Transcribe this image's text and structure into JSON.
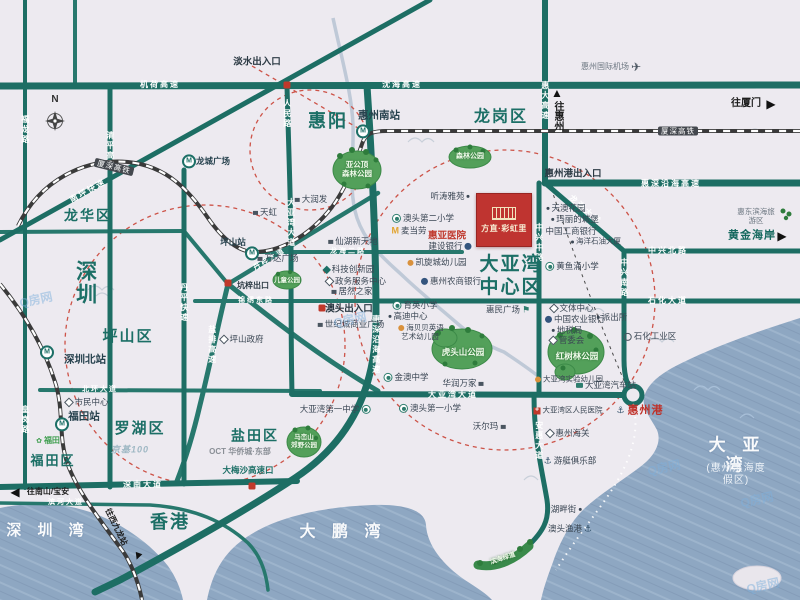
{
  "project": {
    "name": "方直·彩虹里"
  },
  "compass": {
    "label": "N"
  },
  "watermark": {
    "text": "Q房网"
  },
  "colors": {
    "road_teal": "#1d6e64",
    "district_teal": "#1c6f66",
    "project_red": "#bf3430",
    "water_blue": "#8ea7c2",
    "park_green": "#53a05a",
    "alert_red": "#cd5348"
  },
  "labels": [
    {
      "t": "龙岗区",
      "x": 501,
      "y": 117,
      "c": "d",
      "s": 16,
      "n": "district-longgang"
    },
    {
      "t": "惠阳",
      "x": 328,
      "y": 122,
      "c": "d",
      "s": 18,
      "n": "district-huiyang"
    },
    {
      "t": "龙华区",
      "x": 88,
      "y": 216,
      "c": "d",
      "s": 14,
      "n": "district-longhua"
    },
    {
      "t": "深圳",
      "x": 85,
      "y": 283,
      "c": "d",
      "s": 21,
      "v": 1,
      "n": "district-shenzhen"
    },
    {
      "t": "坪山区",
      "x": 128,
      "y": 337,
      "c": "d",
      "s": 15,
      "n": "district-pingshan"
    },
    {
      "t": "罗湖区",
      "x": 140,
      "y": 429,
      "c": "d",
      "s": 15,
      "n": "district-luohu"
    },
    {
      "t": "福田区",
      "x": 53,
      "y": 461,
      "c": "d",
      "s": 13,
      "n": "district-futian"
    },
    {
      "t": "盐田区",
      "x": 255,
      "y": 436,
      "c": "d",
      "s": 14,
      "n": "district-yantian"
    },
    {
      "t": "香港",
      "x": 170,
      "y": 523,
      "c": "d",
      "s": 18,
      "n": "district-hongkong"
    },
    {
      "t": "大亚湾\n中心区",
      "x": 511,
      "y": 277,
      "c": "d",
      "s": 19,
      "n": "district-dayawan-center"
    },
    {
      "t": "深 圳 湾",
      "x": 48,
      "y": 531,
      "c": "w",
      "s": 15,
      "n": "water-shenzhen-bay"
    },
    {
      "t": "大 鹏 湾",
      "x": 343,
      "y": 532,
      "c": "w",
      "s": 16,
      "n": "water-dapeng-bay"
    },
    {
      "t": "大 亚 湾",
      "x": 737,
      "y": 456,
      "c": "w",
      "s": 17,
      "n": "water-daya-bay"
    },
    {
      "t": "(惠州滨海度假区)",
      "x": 736,
      "y": 475,
      "c": "ws",
      "s": 10,
      "n": "water-daya-bay-subtitle"
    },
    {
      "t": "机荷高速",
      "x": 160,
      "y": 85,
      "c": "rh",
      "n": "road-jihe-expwy"
    },
    {
      "t": "沈海高速",
      "x": 402,
      "y": 85,
      "c": "rh",
      "n": "road-shenhai-expwy"
    },
    {
      "t": "惠大高速",
      "x": 545,
      "y": 101,
      "c": "rv",
      "n": "road-huida-expwy"
    },
    {
      "t": "惠深沿海高速",
      "x": 671,
      "y": 184,
      "c": "rh",
      "n": "road-huishen-coastal-e"
    },
    {
      "t": "龙海大道",
      "x": 585,
      "y": 210,
      "c": "rh",
      "r": 41,
      "n": "road-longhai-ave"
    },
    {
      "t": "中兴北路",
      "x": 668,
      "y": 251,
      "c": "rh",
      "n": "road-zhongxing-north"
    },
    {
      "t": "中兴南路",
      "x": 624,
      "y": 278,
      "c": "rv",
      "n": "road-zhongxing-south"
    },
    {
      "t": "中兴中路",
      "x": 539,
      "y": 243,
      "c": "rv",
      "n": "road-zhongxing-middle"
    },
    {
      "t": "石化大道",
      "x": 668,
      "y": 301,
      "c": "rh",
      "n": "road-shihua-ave"
    },
    {
      "t": "大亚湾大道",
      "x": 453,
      "y": 395,
      "c": "rh",
      "n": "road-dayawan-ave-h"
    },
    {
      "t": "安惠大道",
      "x": 539,
      "y": 441,
      "c": "rv",
      "n": "road-anhui-ave"
    },
    {
      "t": "惠深沿海高速",
      "x": 376,
      "y": 345,
      "c": "rv",
      "n": "road-huishen-coastal-v"
    },
    {
      "t": "深南大道",
      "x": 143,
      "y": 485,
      "c": "rh",
      "n": "road-shennan-ave"
    },
    {
      "t": "滨河大道",
      "x": 66,
      "y": 503,
      "c": "rh",
      "s": 7,
      "n": "road-binhe-ave"
    },
    {
      "t": "北环大道",
      "x": 100,
      "y": 390,
      "c": "rh",
      "s": 7,
      "n": "road-beihuan-ave"
    },
    {
      "t": "清平高速",
      "x": 110,
      "y": 151,
      "c": "rv",
      "n": "road-qingping-expwy"
    },
    {
      "t": "福龙路",
      "x": 25,
      "y": 130,
      "c": "rv",
      "n": "road-fulong"
    },
    {
      "t": "皇岗路",
      "x": 25,
      "y": 420,
      "c": "rv",
      "n": "road-huanggang"
    },
    {
      "t": "丹平快速",
      "x": 184,
      "y": 303,
      "c": "rv",
      "n": "road-danping-expwy"
    },
    {
      "t": "盐排高速",
      "x": 212,
      "y": 345,
      "c": "rv",
      "n": "road-yanpai-expwy"
    },
    {
      "t": "南坪快速",
      "x": 88,
      "y": 191,
      "c": "rh",
      "r": -29,
      "n": "road-nanping-expwy"
    },
    {
      "t": "人民路",
      "x": 287,
      "y": 114,
      "c": "rv",
      "n": "road-renmin"
    },
    {
      "t": "大亚湾大道",
      "x": 291,
      "y": 223,
      "c": "rv",
      "n": "road-dayawan-ave-v"
    },
    {
      "t": "龙海二路",
      "x": 348,
      "y": 252,
      "c": "rh",
      "s": 7,
      "n": "road-longhai-2"
    },
    {
      "t": "锦绣东路",
      "x": 256,
      "y": 301,
      "c": "rh",
      "s": 7,
      "n": "road-jinxiu-east"
    },
    {
      "t": "丹梓大道",
      "x": 270,
      "y": 260,
      "c": "rh",
      "r": -31,
      "s": 7,
      "n": "road-danzi-ave"
    },
    {
      "t": "厦深高铁",
      "x": 114,
      "y": 167,
      "c": "rl",
      "r": 14,
      "n": "rail-xiashen-hsr-w"
    },
    {
      "t": "厦深高铁",
      "x": 678,
      "y": 131,
      "c": "rl",
      "n": "rail-xiashen-hsr-e"
    },
    {
      "t": "惠州南站",
      "x": 379,
      "y": 116,
      "c": "st",
      "n": "station-huizhou-south"
    },
    {
      "t": "坪山站",
      "x": 233,
      "y": 242,
      "c": "st2",
      "n": "station-pingshan"
    },
    {
      "t": "深圳北站",
      "x": 85,
      "y": 360,
      "c": "st",
      "n": "station-shenzhen-north"
    },
    {
      "t": "福田站",
      "x": 84,
      "y": 417,
      "c": "st",
      "n": "station-futian"
    },
    {
      "t": "龙城广场",
      "x": 213,
      "y": 161,
      "c": "st2",
      "n": "station-longcheng-square"
    },
    {
      "c": "icm",
      "x": 363,
      "y": 131,
      "n": "metro-icon-huizhou-south"
    },
    {
      "c": "icm",
      "x": 252,
      "y": 253,
      "n": "metro-icon-pingshan"
    },
    {
      "c": "icm",
      "x": 47,
      "y": 352,
      "n": "metro-icon-shenzhen-north"
    },
    {
      "c": "icm",
      "x": 62,
      "y": 424,
      "n": "metro-icon-futian"
    },
    {
      "c": "icm",
      "x": 189,
      "y": 161,
      "n": "metro-icon-longcheng"
    },
    {
      "t": "淡水出入口",
      "x": 257,
      "y": 62,
      "c": "gate",
      "n": "gate-danshui"
    },
    {
      "t": "惠州港出入口",
      "x": 573,
      "y": 174,
      "c": "gate",
      "n": "gate-huizhou-port"
    },
    {
      "t": "澳头出入口",
      "x": 349,
      "y": 309,
      "c": "gate",
      "n": "gate-aotou"
    },
    {
      "t": "坑梓出口",
      "x": 253,
      "y": 286,
      "c": "gate",
      "s": 8,
      "n": "gate-kengzi"
    },
    {
      "t": "大梅沙高速口",
      "x": 248,
      "y": 470,
      "c": "gate2",
      "n": "gate-dameisha"
    },
    {
      "t": "▲",
      "x": 557,
      "y": 93,
      "c": "dirA",
      "n": "arrow-up-to-huizhou"
    },
    {
      "t": "往惠州",
      "x": 557,
      "y": 116,
      "c": "dir",
      "v": 1,
      "n": "dir-to-huizhou"
    },
    {
      "t": "往厦门",
      "x": 746,
      "y": 104,
      "c": "dir",
      "n": "dir-to-xiamen"
    },
    {
      "t": "▶",
      "x": 771,
      "y": 104,
      "c": "dirA",
      "n": "arrow-right-to-xiamen"
    },
    {
      "t": "黄金海岸",
      "x": 752,
      "y": 236,
      "c": "coast",
      "n": "poi-golden-coast"
    },
    {
      "t": "▶",
      "x": 782,
      "y": 236,
      "c": "dirA",
      "n": "arrow-right-golden-coast"
    },
    {
      "t": "◀",
      "x": 15,
      "y": 492,
      "c": "dirA",
      "n": "arrow-left-nanshan"
    },
    {
      "t": "往南山/宝安",
      "x": 48,
      "y": 492,
      "c": "dir",
      "s": 8,
      "n": "dir-to-nanshan-baoan"
    },
    {
      "t": "往西九龙站",
      "x": 116,
      "y": 527,
      "c": "dir",
      "r": 64,
      "s": 8,
      "n": "dir-to-west-kowloon"
    },
    {
      "t": "▼",
      "x": 138,
      "y": 556,
      "c": "dirA",
      "r": 20,
      "n": "arrow-down-west-kowloon"
    },
    {
      "t": "天虹",
      "x": 264,
      "y": 212,
      "c": "poi",
      "ic": "mall",
      "n": "poi-tianhong"
    },
    {
      "t": "大润发",
      "x": 310,
      "y": 199,
      "c": "poi",
      "ic": "mall",
      "n": "poi-rtmart"
    },
    {
      "t": "万达广场",
      "x": 277,
      "y": 258,
      "c": "poi",
      "ic": "mall",
      "n": "poi-wanda-plaza"
    },
    {
      "t": "坪山政府",
      "x": 241,
      "y": 339,
      "c": "poi",
      "ic": "gov",
      "n": "poi-pingshan-gov"
    },
    {
      "t": "市民中心",
      "x": 86,
      "y": 402,
      "c": "poi",
      "ic": "gov",
      "n": "poi-civic-center"
    },
    {
      "t": "京基100",
      "x": 130,
      "y": 450,
      "c": "lg1",
      "n": "poi-kk100"
    },
    {
      "t": "福田",
      "x": 47,
      "y": 441,
      "c": "lg2",
      "ic": "flower",
      "n": "poi-futian-logo"
    },
    {
      "t": "OCT 华侨城·东部",
      "x": 240,
      "y": 452,
      "c": "lg3",
      "n": "poi-oct-east"
    },
    {
      "t": "听涛雅苑",
      "x": 451,
      "y": 196,
      "c": "poi",
      "ic": "dot",
      "icr": 1,
      "n": "poi-tingtao-yayuan"
    },
    {
      "t": "澳头第二小学",
      "x": 422,
      "y": 218,
      "c": "poi",
      "ic": "school",
      "n": "poi-aotou-2nd-primary"
    },
    {
      "t": "麦当劳",
      "x": 408,
      "y": 231,
      "c": "poi",
      "ic": "mcd",
      "n": "poi-mcdonalds"
    },
    {
      "t": "惠亚医院",
      "x": 447,
      "y": 236,
      "c": "red1",
      "n": "poi-huiya-hospital"
    },
    {
      "t": "建设银行",
      "x": 451,
      "y": 246,
      "c": "poi",
      "ic": "bank",
      "icr": 1,
      "n": "poi-ccb-bank"
    },
    {
      "t": "凯旋城幼儿园",
      "x": 436,
      "y": 262,
      "c": "poi",
      "ic": "kid",
      "n": "poi-kaixuancheng-kindergarten"
    },
    {
      "t": "惠州农商银行",
      "x": 450,
      "y": 281,
      "c": "poi",
      "ic": "bank",
      "n": "poi-huizhou-rural-bank"
    },
    {
      "t": "仙湖新天地",
      "x": 352,
      "y": 241,
      "c": "poi",
      "ic": "mall",
      "n": "poi-xianhu-xintiandi"
    },
    {
      "t": "科技创新园",
      "x": 348,
      "y": 269,
      "c": "poi",
      "ic": "dia",
      "n": "poi-tech-innovation-park"
    },
    {
      "t": "政务服务中心",
      "x": 355,
      "y": 281,
      "c": "poi",
      "ic": "gov",
      "n": "poi-gov-service-center"
    },
    {
      "t": "居然之家",
      "x": 351,
      "y": 291,
      "c": "poi",
      "ic": "mall",
      "n": "poi-juran-home"
    },
    {
      "t": "世纪城商业广场",
      "x": 350,
      "y": 324,
      "c": "poi",
      "ic": "mall",
      "n": "poi-century-city-plaza"
    },
    {
      "t": "育英小学",
      "x": 414,
      "y": 305,
      "c": "poi",
      "ic": "school",
      "n": "poi-yuying-primary"
    },
    {
      "t": "高迪中心",
      "x": 407,
      "y": 316,
      "c": "poi",
      "ic": "dot",
      "n": "poi-gaodi-center"
    },
    {
      "t": "海贝贝英语\n艺术幼儿园",
      "x": 420,
      "y": 332,
      "c": "poi",
      "ic": "kid",
      "s": 7.5,
      "n": "poi-haibeibei-kindergarten"
    },
    {
      "t": "金澳中学",
      "x": 405,
      "y": 377,
      "c": "poi",
      "ic": "school",
      "n": "poi-jinao-middle-school"
    },
    {
      "t": "华润万家",
      "x": 464,
      "y": 383,
      "c": "poi",
      "ic": "mall",
      "icr": 1,
      "n": "poi-cr-vanguard"
    },
    {
      "t": "大亚湾第一中学",
      "x": 336,
      "y": 409,
      "c": "poi",
      "ic": "school",
      "icr": 1,
      "n": "poi-dayawan-1st-middle"
    },
    {
      "t": "澳头第一小学",
      "x": 429,
      "y": 408,
      "c": "poi",
      "ic": "school",
      "n": "poi-aotou-1st-primary"
    },
    {
      "t": "沃尔玛",
      "x": 490,
      "y": 426,
      "c": "poi",
      "ic": "mall",
      "icr": 1,
      "n": "poi-walmart"
    },
    {
      "t": "惠民广场",
      "x": 509,
      "y": 310,
      "c": "poi",
      "ic": "flag",
      "icr": 1,
      "n": "poi-huimin-square"
    },
    {
      "t": "文体中心",
      "x": 571,
      "y": 308,
      "c": "poi",
      "ic": "gov",
      "n": "poi-sports-center"
    },
    {
      "t": "中国农业银行",
      "x": 574,
      "y": 319,
      "c": "poi",
      "ic": "bank",
      "n": "poi-abc-bank"
    },
    {
      "t": "地税局",
      "x": 566,
      "y": 330,
      "c": "poi",
      "ic": "dot",
      "n": "poi-tax-bureau"
    },
    {
      "t": "管委会",
      "x": 566,
      "y": 340,
      "c": "poi",
      "ic": "gov",
      "n": "poi-admin-committee"
    },
    {
      "t": "派出所",
      "x": 611,
      "y": 317,
      "c": "poi",
      "ic": "dot",
      "n": "poi-police-station"
    },
    {
      "t": "天澳花园",
      "x": 565,
      "y": 208,
      "c": "poi",
      "ic": "dot",
      "n": "poi-tianao-garden"
    },
    {
      "t": "玛丽的城堡",
      "x": 574,
      "y": 219,
      "c": "poi",
      "ic": "dot",
      "n": "poi-marys-castle"
    },
    {
      "t": "中国工商银行",
      "x": 571,
      "y": 231,
      "c": "poi",
      "n": "poi-icbc-bank"
    },
    {
      "t": "海洋石油大厦",
      "x": 595,
      "y": 241,
      "c": "poi",
      "ic": "dot",
      "s": 7.5,
      "n": "poi-cnooc-tower"
    },
    {
      "t": "黄鱼涌小学",
      "x": 571,
      "y": 266,
      "c": "poi",
      "ic": "school",
      "n": "poi-huangyuchong-primary"
    },
    {
      "t": "石化工业区",
      "x": 649,
      "y": 336,
      "c": "poi",
      "ic": "ring",
      "n": "poi-petrochemical-zone"
    },
    {
      "t": "大亚湾实验幼儿园",
      "x": 568,
      "y": 379,
      "c": "poi",
      "ic": "kid",
      "s": 7.5,
      "n": "poi-dayawan-exp-kindergarten"
    },
    {
      "t": "大亚湾汽车站",
      "x": 605,
      "y": 385,
      "c": "poi",
      "ic": "bus",
      "n": "poi-dayawan-bus-station"
    },
    {
      "t": "大亚湾区人民医院",
      "x": 567,
      "y": 410,
      "c": "poi",
      "ic": "hosp",
      "s": 7.5,
      "n": "poi-dayawan-peoples-hospital"
    },
    {
      "t": "惠州海关",
      "x": 567,
      "y": 433,
      "c": "poi",
      "ic": "gov",
      "n": "poi-huizhou-customs"
    },
    {
      "t": "游艇俱乐部",
      "x": 569,
      "y": 461,
      "c": "poi",
      "ic": "anchor",
      "n": "poi-yacht-club"
    },
    {
      "t": "湖畔街",
      "x": 567,
      "y": 509,
      "c": "poi",
      "ic": "dot",
      "icr": 1,
      "n": "poi-hupan-street"
    },
    {
      "t": "澳头渔港",
      "x": 571,
      "y": 529,
      "c": "poi",
      "ic": "anchor",
      "icr": 1,
      "n": "poi-aotou-fishing-port"
    },
    {
      "t": "惠东滨海旅游区",
      "x": 756,
      "y": 216,
      "c": "poi2",
      "s": 7.5,
      "n": "poi-huidong-coastal-resort"
    },
    {
      "t": "惠州国际机场",
      "x": 612,
      "y": 67,
      "c": "poi2",
      "ic": "plane",
      "icr": 1,
      "n": "poi-huizhou-airport"
    },
    {
      "t": "惠州港",
      "x": 639,
      "y": 411,
      "c": "port",
      "ic": "anchor",
      "n": "poi-huizhou-port"
    },
    {
      "t": "亚公顶\n森林公园",
      "x": 357,
      "y": 169,
      "c": "park",
      "s": 7.5,
      "n": "park-yagongding"
    },
    {
      "t": "森林公园",
      "x": 470,
      "y": 157,
      "c": "park",
      "s": 7,
      "n": "park-forest"
    },
    {
      "t": "儿童公园",
      "x": 287,
      "y": 281,
      "c": "park",
      "s": 6.5,
      "n": "park-children"
    },
    {
      "t": "虎头山公园",
      "x": 463,
      "y": 352,
      "c": "park",
      "s": 8.5,
      "n": "park-hutoushan"
    },
    {
      "t": "红树林公园",
      "x": 577,
      "y": 356,
      "c": "park",
      "s": 8.5,
      "n": "park-mangrove"
    },
    {
      "t": "马峦山\n郊野公园",
      "x": 304,
      "y": 442,
      "c": "park",
      "s": 6.5,
      "n": "park-maluanshan"
    },
    {
      "t": "滨海绿道",
      "x": 503,
      "y": 559,
      "c": "park",
      "s": 6.5,
      "r": -18,
      "n": "park-coastal-greenway"
    },
    {
      "t": "N",
      "x": 55,
      "y": 100,
      "c": "cn",
      "n": "compass-north-label"
    },
    {
      "t": "Q房网",
      "x": 36,
      "y": 300,
      "c": "wm",
      "r": -12,
      "n": "watermark-1"
    },
    {
      "t": "Q房网",
      "x": 350,
      "y": 320,
      "c": "wm",
      "r": -12,
      "n": "watermark-2"
    },
    {
      "t": "Q房网",
      "x": 664,
      "y": 468,
      "c": "wm",
      "r": -12,
      "n": "watermark-3"
    },
    {
      "t": "Q房网",
      "x": 757,
      "y": 500,
      "c": "wm",
      "r": -12,
      "n": "watermark-4"
    },
    {
      "t": "Q房网",
      "x": 763,
      "y": 586,
      "c": "wm",
      "r": -12,
      "n": "watermark-5"
    }
  ]
}
